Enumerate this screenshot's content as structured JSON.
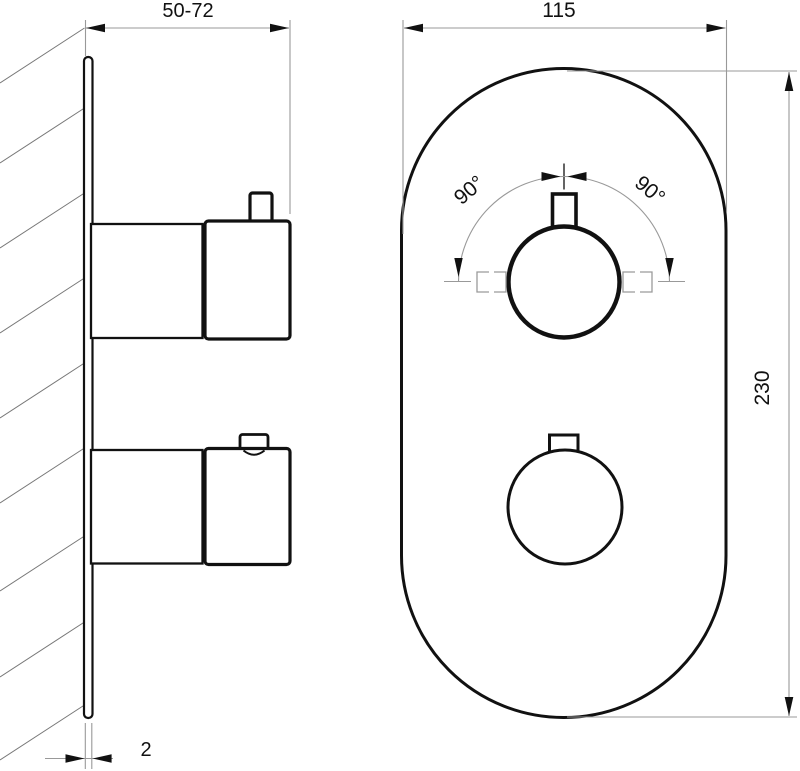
{
  "dims": {
    "depth_range": "50-72",
    "width": "115",
    "height": "230",
    "thickness": "2",
    "rotation_left": "90°",
    "rotation_right": "90°"
  },
  "colors": {
    "outline": "#111111",
    "dimension_line": "#999999",
    "hatch": "#777777",
    "arrow": "#111111",
    "text": "#111111",
    "background": "#ffffff"
  }
}
